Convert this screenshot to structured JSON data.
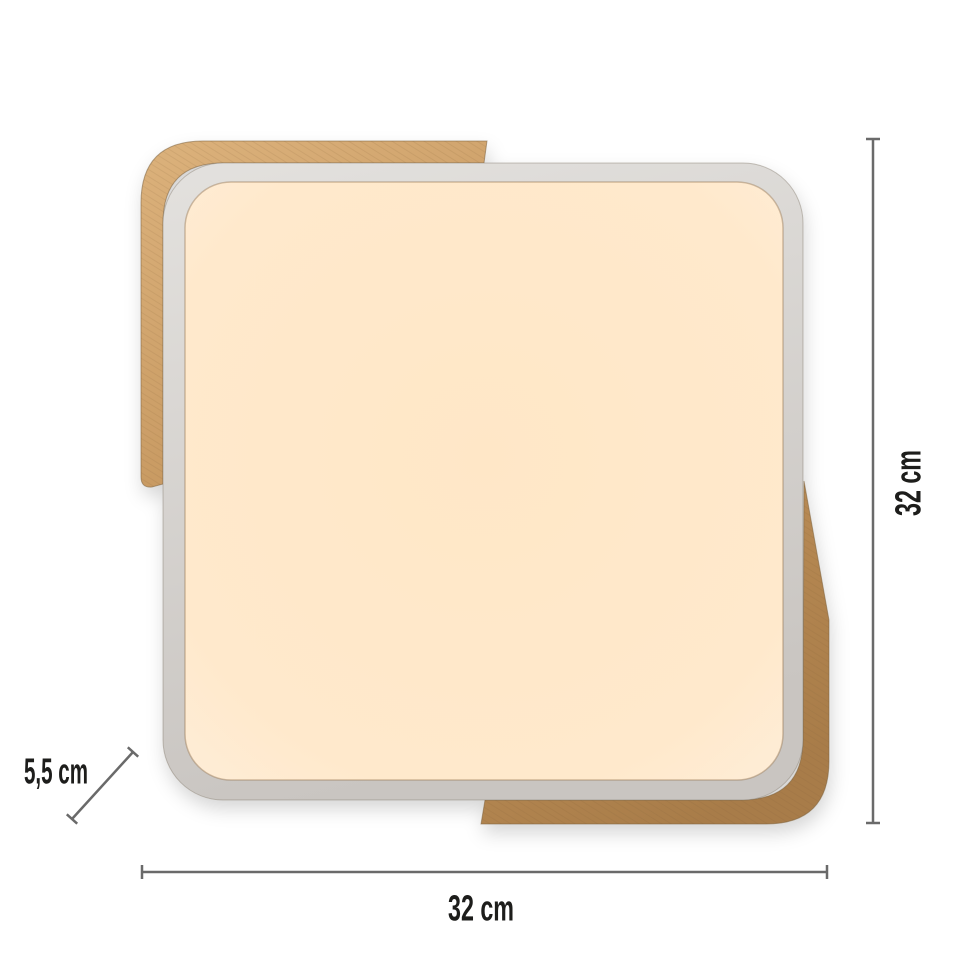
{
  "lamp": {
    "wood_light": "#dcb27c",
    "wood_mid": "#c3945c",
    "wood_dark": "#a87c49",
    "frame_light": "#e3e1de",
    "frame_dark": "#c9c5c1",
    "panel_center": "#ffe7c7",
    "panel_edge": "#feeeda",
    "seam": "#7b6240"
  },
  "dimensions": {
    "line_color": "#6a6a6a",
    "text_color": "#1d1d1b",
    "height_label": "32 cm",
    "width_label": "32 cm",
    "depth_label": "5,5 cm"
  }
}
